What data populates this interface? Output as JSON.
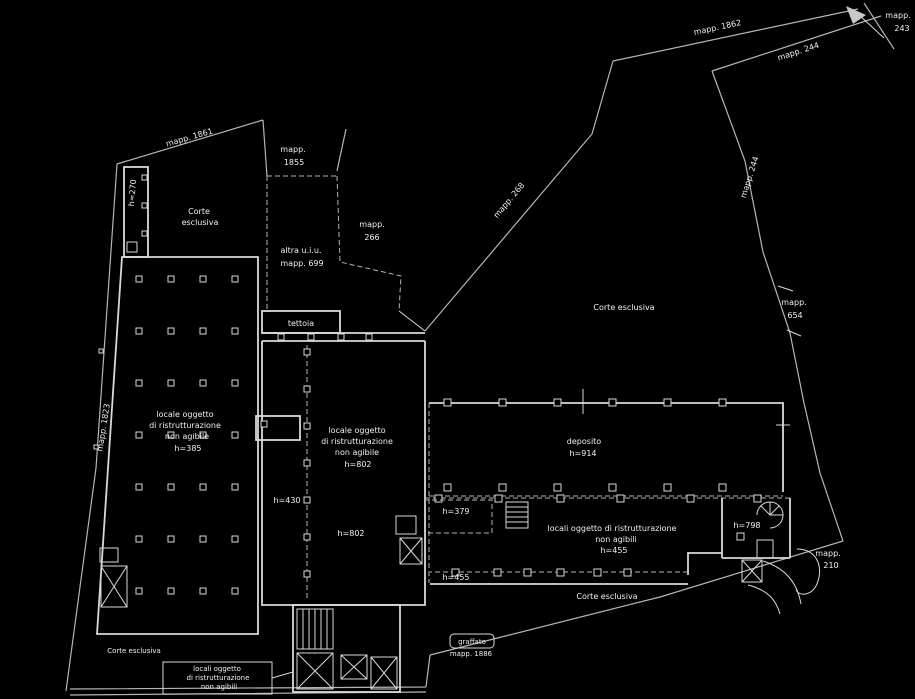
{
  "drawing": {
    "type": "cadastral-floor-plan",
    "colors": {
      "background": "#000000",
      "lines": "#b5b5b5",
      "walls": "#d9d9d9",
      "text": "#f0f0f0"
    }
  },
  "labels": {
    "mapp_1862": "mapp. 1862",
    "mapp_244_top": "mapp. 244",
    "mapp_243_l1": "mapp.",
    "mapp_243_l2": "243",
    "mapp_244_side": "mapp. 244",
    "mapp_654_l1": "mapp.",
    "mapp_654_l2": "654",
    "mapp_1861": "mapp. 1861",
    "h270": "h=270",
    "corte_nw_l1": "Corte",
    "corte_nw_l2": "esclusiva",
    "mapp_1855_l1": "mapp.",
    "mapp_1855_l2": "1855",
    "altra_l1": "altra u.i.u.",
    "altra_l2": "mapp. 699",
    "mapp_266_l1": "mapp.",
    "mapp_266_l2": "266",
    "tettoia": "tettoia",
    "mapp_268": "mapp. 268",
    "corte_ne": "Corte esclusiva",
    "mapp_1823": "mapp. 1823",
    "locale_sx_l1": "locale oggetto",
    "locale_sx_l2": "di ristrutturazione",
    "locale_sx_l3": "non agibile",
    "locale_sx_l4": "h=385",
    "locale_cx_l1": "locale oggetto",
    "locale_cx_l2": "di ristrutturazione",
    "locale_cx_l3": "non agibile",
    "locale_cx_l4": "h=802",
    "h430": "h=430",
    "h802": "h=802",
    "deposito_l1": "deposito",
    "deposito_l2": "h=914",
    "h379": "h=379",
    "locali_cx_l1": "locali oggetto di ristrutturazione",
    "locali_cx_l2": "non agibili",
    "locali_cx_l3": "h=455",
    "h798": "h=798",
    "h455": "h=455",
    "corte_se": "Corte esclusiva",
    "corte_sw": "Corte esclusiva",
    "locali_sw_l1": "locali oggetto",
    "locali_sw_l2": "di ristrutturazione",
    "locali_sw_l3": "non agibili",
    "graffato_l1": "graffato",
    "graffato_l2": "mapp. 1886",
    "mapp_210_l1": "mapp.",
    "mapp_210_l2": "210"
  }
}
